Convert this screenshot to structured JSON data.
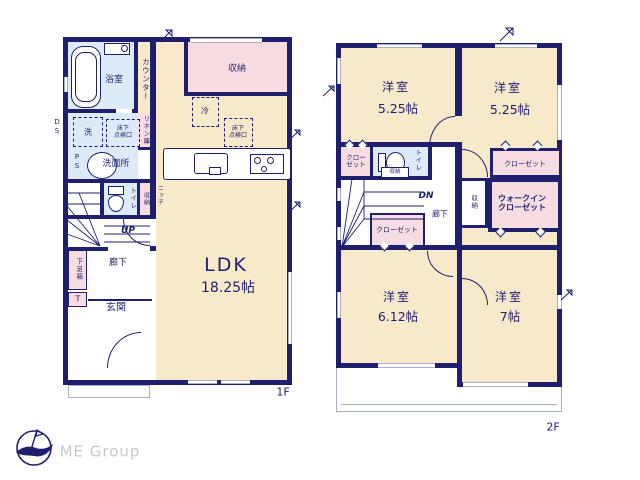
{
  "colors": {
    "wall": "#1f1f6e",
    "floor": "#f7e9c9",
    "pink": "#f7dce2",
    "blue": "#dcebf7",
    "gray": "#a9afc4",
    "logo": "#c9c9c9"
  },
  "floor1": {
    "label": "1F",
    "bathroom": "浴室",
    "counter": "カウンター",
    "washer": "洗",
    "hatch_a_line1": "床下",
    "hatch_a_line2": "点検口",
    "linen": "リネン庫",
    "ps": "PS",
    "ds": "DS",
    "toilet": "トイレ",
    "storage_small": "収納",
    "niche": "ニッチ",
    "up": "UP",
    "hallway": "廊下",
    "shoebox": "下足箱",
    "t": "T",
    "entrance": "玄関",
    "ldk": "LDK",
    "ldk_size": "18.25帖",
    "storage": "収納",
    "fridge": "冷",
    "hatch_b_line1": "床下",
    "hatch_b_line2": "点検口",
    "washroom": "洗面所"
  },
  "floor2": {
    "label": "2F",
    "room_tl": "洋室",
    "room_tl_size": "5.25帖",
    "room_tr": "洋室",
    "room_tr_size": "5.25帖",
    "room_bl": "洋室",
    "room_bl_size": "6.12帖",
    "room_br": "洋室",
    "room_br_size": "7帖",
    "closet_line1": "クロー",
    "closet_line2": "ゼット",
    "toilet": "トイレ",
    "toilet_storage": "収納",
    "closet_top": "クローゼット",
    "wic_line1": "ウォークイン",
    "wic_line2": "クローゼット",
    "storage": "収納",
    "dn": "DN",
    "hallway": "廊下",
    "closet_mid": "クローゼット"
  },
  "logo": {
    "company": "ME Group"
  }
}
